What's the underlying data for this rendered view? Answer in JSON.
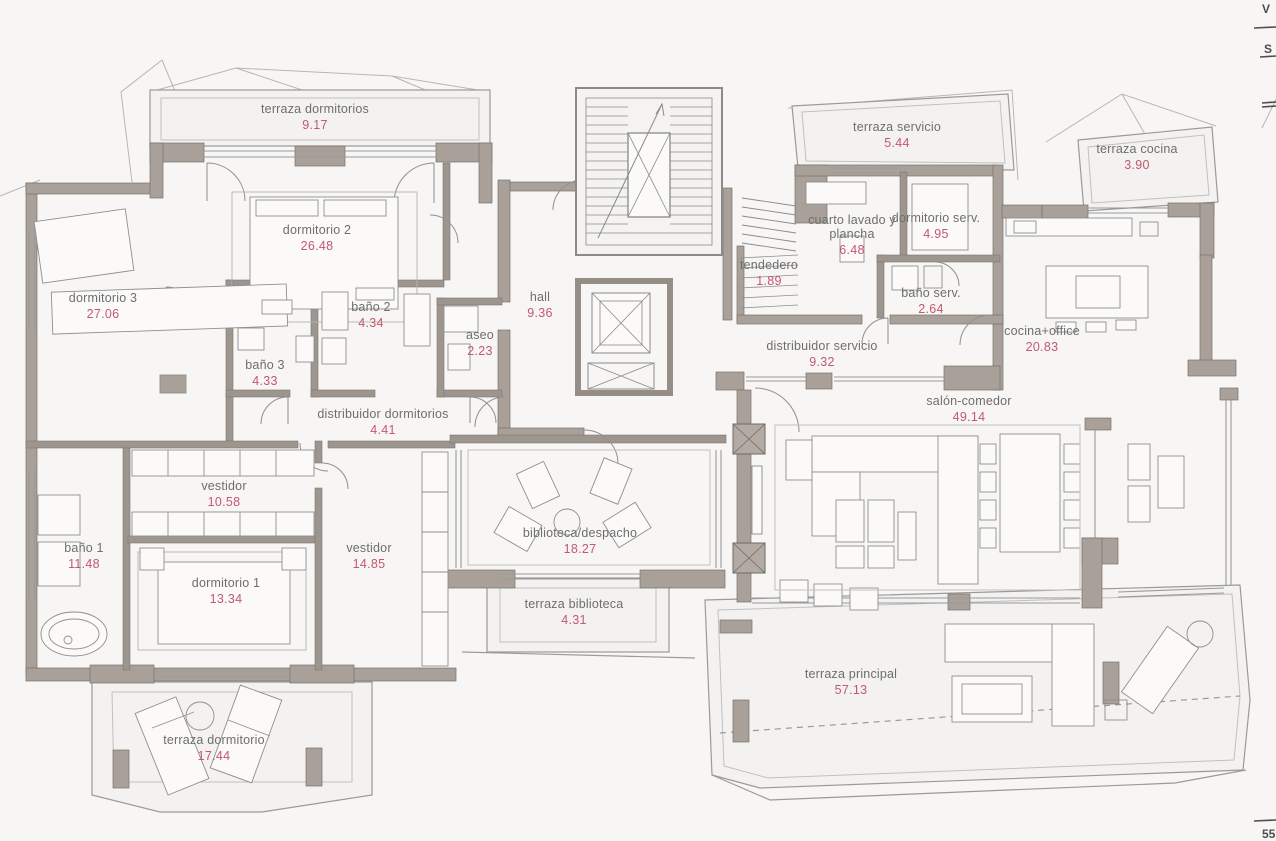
{
  "document": {
    "kind": "architectural floor plan",
    "language": "es"
  },
  "colors": {
    "paper": "#f7f6f5",
    "wall": "#a9a199",
    "interior_wall": "#9d968e",
    "line": "#8f8f8f",
    "label_text": "#6e6e6e",
    "area_text": "#c2596d"
  },
  "rooms": [
    {
      "name": "terraza dormitorios",
      "area": "9.17"
    },
    {
      "name": "dormitorio 2",
      "area": "26.48"
    },
    {
      "name": "dormitorio 3",
      "area": "27.06"
    },
    {
      "name": "baño 2",
      "area": "4.34"
    },
    {
      "name": "baño 3",
      "area": "4.33"
    },
    {
      "name": "aseo",
      "area": "2.23"
    },
    {
      "name": "hall",
      "area": "9.36"
    },
    {
      "name": "distribuidor dormitorios",
      "area": "4.41"
    },
    {
      "name": "vestidor",
      "area": "10.58"
    },
    {
      "name": "baño 1",
      "area": "11.48"
    },
    {
      "name": "dormitorio 1",
      "area": "13.34"
    },
    {
      "name": "vestidor",
      "area": "14.85"
    },
    {
      "name": "biblioteca/despacho",
      "area": "18.27"
    },
    {
      "name": "terraza biblioteca",
      "area": "4.31"
    },
    {
      "name": "terraza dormitorio",
      "area": "17.44"
    },
    {
      "name": "terraza servicio",
      "area": "5.44"
    },
    {
      "name": "cuarto lavado y plancha",
      "area": "6.48"
    },
    {
      "name": "dormitorio serv.",
      "area": "4.95"
    },
    {
      "name": "tendedero",
      "area": "1.89"
    },
    {
      "name": "baño serv.",
      "area": "2.64"
    },
    {
      "name": "terraza cocina",
      "area": "3.90"
    },
    {
      "name": "cocina+office",
      "area": "20.83"
    },
    {
      "name": "distribuidor servicio",
      "area": "9.32"
    },
    {
      "name": "salón-comedor",
      "area": "49.14"
    },
    {
      "name": "terraza principal",
      "area": "57.13"
    }
  ],
  "edge_marks": {
    "top_right_v": "V",
    "top_right_s": "S",
    "bottom_right": "55"
  }
}
